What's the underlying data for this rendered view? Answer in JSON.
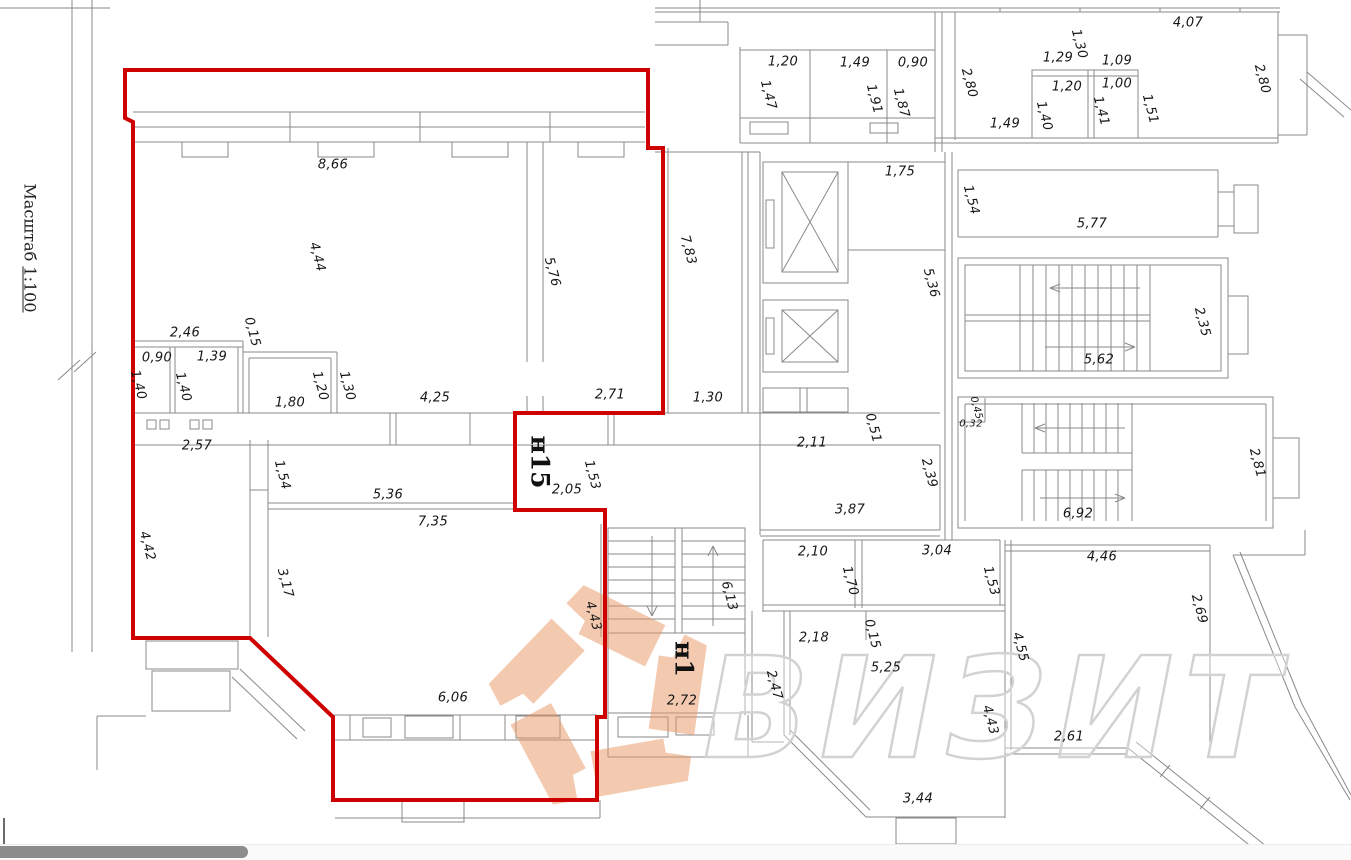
{
  "scale": {
    "word": "Масштаб",
    "value": "1:100"
  },
  "watermark": {
    "text": "ВИЗИТ",
    "logo_color": "#e8935f",
    "text_outline_color": "#d2d2d2"
  },
  "colors": {
    "unit_outline_red": "#cf0000",
    "drawing_line_grey": "#8a8a8a",
    "label_text": "#161616"
  },
  "room_labels": [
    {
      "t": "н15",
      "x": 540,
      "y": 462
    },
    {
      "t": "н1",
      "x": 684,
      "y": 659
    }
  ],
  "dimensions": [
    {
      "t": "8,66",
      "x": 333,
      "y": 165,
      "o": "h"
    },
    {
      "t": "4,44",
      "x": 317,
      "y": 257,
      "o": "v"
    },
    {
      "t": "5,76",
      "x": 552,
      "y": 272,
      "o": "v"
    },
    {
      "t": "7,83",
      "x": 688,
      "y": 250,
      "o": "v"
    },
    {
      "t": "2,46",
      "x": 185,
      "y": 333,
      "o": "h"
    },
    {
      "t": "0,15",
      "x": 252,
      "y": 332,
      "o": "v"
    },
    {
      "t": "0,90",
      "x": 157,
      "y": 358,
      "o": "h"
    },
    {
      "t": "1,39",
      "x": 212,
      "y": 357,
      "o": "h"
    },
    {
      "t": "1,40",
      "x": 138,
      "y": 385,
      "o": "v"
    },
    {
      "t": "1,40",
      "x": 183,
      "y": 387,
      "o": "v"
    },
    {
      "t": "1,20",
      "x": 320,
      "y": 386,
      "o": "v"
    },
    {
      "t": "1,30",
      "x": 347,
      "y": 386,
      "o": "v"
    },
    {
      "t": "1,80",
      "x": 290,
      "y": 403,
      "o": "h"
    },
    {
      "t": "4,25",
      "x": 435,
      "y": 398,
      "o": "h"
    },
    {
      "t": "2,71",
      "x": 610,
      "y": 395,
      "o": "h"
    },
    {
      "t": "1,30",
      "x": 708,
      "y": 398,
      "o": "h"
    },
    {
      "t": "2,57",
      "x": 197,
      "y": 446,
      "o": "h"
    },
    {
      "t": "1,54",
      "x": 282,
      "y": 475,
      "o": "v"
    },
    {
      "t": "5,36",
      "x": 388,
      "y": 495,
      "o": "h"
    },
    {
      "t": "7,35",
      "x": 433,
      "y": 522,
      "o": "h"
    },
    {
      "t": "4,42",
      "x": 147,
      "y": 546,
      "o": "v"
    },
    {
      "t": "3,17",
      "x": 285,
      "y": 583,
      "o": "v"
    },
    {
      "t": "2,05",
      "x": 567,
      "y": 490,
      "o": "h"
    },
    {
      "t": "1,53",
      "x": 592,
      "y": 475,
      "o": "v"
    },
    {
      "t": "4,43",
      "x": 593,
      "y": 616,
      "o": "v"
    },
    {
      "t": "6,06",
      "x": 453,
      "y": 698,
      "o": "h"
    },
    {
      "t": "1,20",
      "x": 783,
      "y": 62,
      "o": "h"
    },
    {
      "t": "1,49",
      "x": 855,
      "y": 63,
      "o": "h"
    },
    {
      "t": "0,90",
      "x": 913,
      "y": 63,
      "o": "h"
    },
    {
      "t": "1,47",
      "x": 768,
      "y": 95,
      "o": "v"
    },
    {
      "t": "1,91",
      "x": 874,
      "y": 99,
      "o": "v"
    },
    {
      "t": "1,87",
      "x": 901,
      "y": 103,
      "o": "v"
    },
    {
      "t": "1,75",
      "x": 900,
      "y": 172,
      "o": "h"
    },
    {
      "t": "5,36",
      "x": 931,
      "y": 283,
      "o": "v"
    },
    {
      "t": "2,80",
      "x": 969,
      "y": 83,
      "o": "v"
    },
    {
      "t": "1,49",
      "x": 1005,
      "y": 124,
      "o": "h"
    },
    {
      "t": "1,29",
      "x": 1058,
      "y": 58,
      "o": "h"
    },
    {
      "t": "1,30",
      "x": 1079,
      "y": 44,
      "o": "v"
    },
    {
      "t": "1,09",
      "x": 1117,
      "y": 61,
      "o": "h"
    },
    {
      "t": "1,20",
      "x": 1067,
      "y": 87,
      "o": "h"
    },
    {
      "t": "1,00",
      "x": 1117,
      "y": 84,
      "o": "h"
    },
    {
      "t": "1,40",
      "x": 1044,
      "y": 116,
      "o": "v"
    },
    {
      "t": "1,41",
      "x": 1101,
      "y": 111,
      "o": "v"
    },
    {
      "t": "1,51",
      "x": 1150,
      "y": 109,
      "o": "v"
    },
    {
      "t": "4,07",
      "x": 1188,
      "y": 23,
      "o": "h"
    },
    {
      "t": "2,80",
      "x": 1262,
      "y": 79,
      "o": "v"
    },
    {
      "t": "1,54",
      "x": 971,
      "y": 200,
      "o": "v"
    },
    {
      "t": "5,77",
      "x": 1092,
      "y": 224,
      "o": "h"
    },
    {
      "t": "2,35",
      "x": 1202,
      "y": 322,
      "o": "v"
    },
    {
      "t": "5,62",
      "x": 1099,
      "y": 360,
      "o": "h"
    },
    {
      "t": "0,45",
      "x": 976,
      "y": 408,
      "o": "v",
      "s": 1
    },
    {
      "t": "0,32",
      "x": 971,
      "y": 424,
      "o": "h",
      "s": 1
    },
    {
      "t": "6,92",
      "x": 1078,
      "y": 514,
      "o": "h"
    },
    {
      "t": "2,81",
      "x": 1257,
      "y": 463,
      "o": "v"
    },
    {
      "t": "2,11",
      "x": 812,
      "y": 443,
      "o": "h"
    },
    {
      "t": "0,51",
      "x": 873,
      "y": 428,
      "o": "v"
    },
    {
      "t": "2,39",
      "x": 929,
      "y": 473,
      "o": "v"
    },
    {
      "t": "3,87",
      "x": 850,
      "y": 510,
      "o": "h"
    },
    {
      "t": "2,10",
      "x": 813,
      "y": 552,
      "o": "h"
    },
    {
      "t": "1,70",
      "x": 850,
      "y": 581,
      "o": "v"
    },
    {
      "t": "3,04",
      "x": 937,
      "y": 551,
      "o": "h"
    },
    {
      "t": "1,53",
      "x": 991,
      "y": 581,
      "o": "v"
    },
    {
      "t": "2,18",
      "x": 814,
      "y": 638,
      "o": "h"
    },
    {
      "t": "0,15",
      "x": 872,
      "y": 634,
      "o": "v"
    },
    {
      "t": "5,25",
      "x": 886,
      "y": 668,
      "o": "h"
    },
    {
      "t": "2,47",
      "x": 774,
      "y": 685,
      "o": "v"
    },
    {
      "t": "6,13",
      "x": 729,
      "y": 596,
      "o": "v"
    },
    {
      "t": "2,72",
      "x": 682,
      "y": 701,
      "o": "h"
    },
    {
      "t": "3,44",
      "x": 918,
      "y": 799,
      "o": "h"
    },
    {
      "t": "4,43",
      "x": 990,
      "y": 720,
      "o": "v"
    },
    {
      "t": "4,55",
      "x": 1020,
      "y": 647,
      "o": "v"
    },
    {
      "t": "4,46",
      "x": 1102,
      "y": 557,
      "o": "h"
    },
    {
      "t": "2,69",
      "x": 1199,
      "y": 609,
      "o": "v"
    },
    {
      "t": "2,61",
      "x": 1069,
      "y": 737,
      "o": "h"
    }
  ]
}
